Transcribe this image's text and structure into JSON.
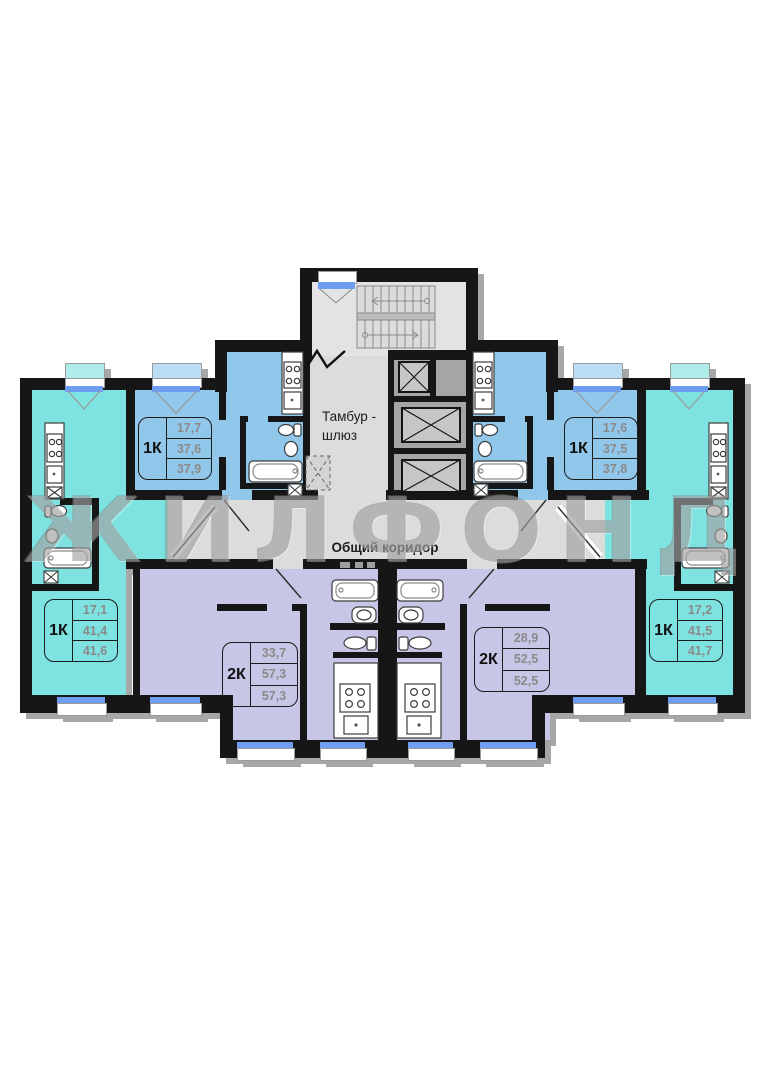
{
  "watermark": "ЖИЛФОНД",
  "labels": {
    "tambur_line1": "Тамбур -",
    "tambur_line2": "шлюз",
    "corridor": "Общий коридор"
  },
  "apartments": [
    {
      "id": "top-left",
      "type": "1К",
      "areas": [
        "17,7",
        "37,6",
        "37,9"
      ]
    },
    {
      "id": "top-right",
      "type": "1К",
      "areas": [
        "17,6",
        "37,5",
        "37,8"
      ]
    },
    {
      "id": "bottom-left",
      "type": "1К",
      "areas": [
        "17,1",
        "41,4",
        "41,6"
      ]
    },
    {
      "id": "bottom-right",
      "type": "1К",
      "areas": [
        "17,2",
        "41,5",
        "41,7"
      ]
    },
    {
      "id": "bottom-middle-left",
      "type": "2К",
      "areas": [
        "33,7",
        "57,3",
        "57,3"
      ]
    },
    {
      "id": "bottom-middle-right",
      "type": "2К",
      "areas": [
        "28,9",
        "52,5",
        "52,5"
      ]
    }
  ],
  "colors": {
    "wall": "#161616",
    "blue": "#92C7EC",
    "blue_window": "#BBDDF5",
    "turquoise": "#7EE2E0",
    "turquoise_window": "#AFECEA",
    "lavender": "#C7C6E6",
    "corridor": "#DCDCDC",
    "stair": "#E3E3E3",
    "elevator": "#A5A5A5",
    "window_sill": "#6D9EF2",
    "watermark_gray": "#7D7D7D"
  }
}
